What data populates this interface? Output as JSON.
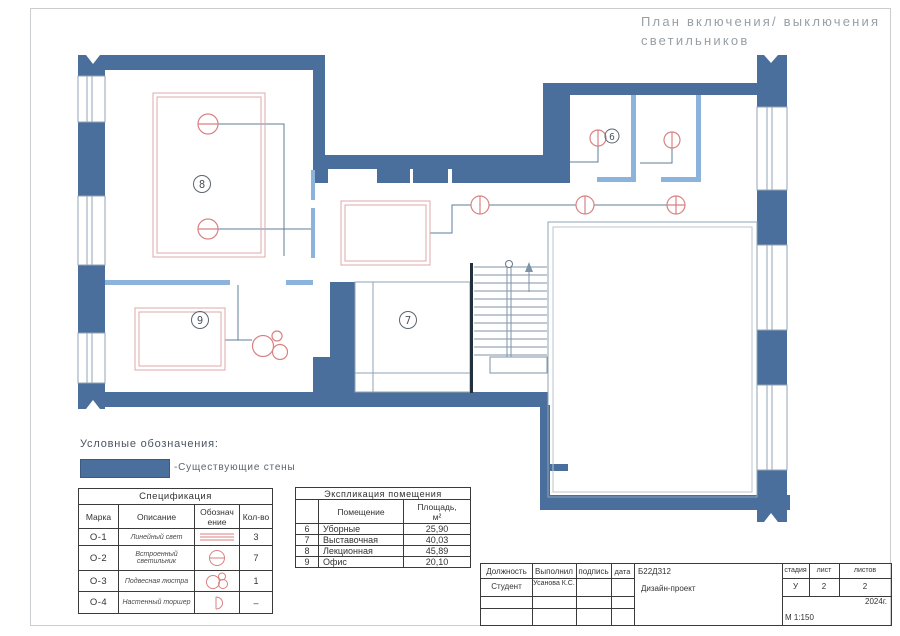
{
  "title": {
    "line1": "План включения/ выключения",
    "line2": "светильников"
  },
  "legend": {
    "heading": "Условные обозначения:",
    "wall_label": "-Существующие стены"
  },
  "rooms": {
    "r6": "6",
    "r7": "7",
    "r8": "8",
    "r9": "9"
  },
  "spec": {
    "title": "Спецификация",
    "col_mark": "Марка",
    "col_desc": "Описание",
    "col_symbol": "Обознач\nение",
    "col_qty": "Кол-во",
    "rows": [
      {
        "mark": "О-1",
        "desc": "Линейный свет",
        "symbol": "linear-light",
        "qty": "3"
      },
      {
        "mark": "О-2",
        "desc": "Встроенный светильник",
        "symbol": "recessed-light",
        "qty": "7"
      },
      {
        "mark": "О-3",
        "desc": "Подвесная люстра",
        "symbol": "pendant-chandelier",
        "qty": "1"
      },
      {
        "mark": "О-4",
        "desc": "Настенный торшер",
        "symbol": "wall-sconce",
        "qty": "–"
      }
    ]
  },
  "explication": {
    "title": "Экспликация помещения",
    "col_room": "Помещение",
    "col_area": "Площадь,\nм²",
    "rows": [
      [
        "6",
        "Уборные",
        "25,90"
      ],
      [
        "7",
        "Выставочная",
        "40,03"
      ],
      [
        "8",
        "Лекционная",
        "45,89"
      ],
      [
        "9",
        "Офис",
        "20,10"
      ]
    ]
  },
  "title_block": {
    "col_position": "Должность",
    "col_performed": "Выполнил",
    "col_signature": "подпись",
    "col_date": "дата",
    "group_code": "Б22Д312",
    "project": "Дизайн-проект",
    "col_stage": "стадия",
    "col_sheet": "лист",
    "col_sheets": "листов",
    "role": "Студент",
    "name": "Усанова К.С.",
    "stage": "У",
    "sheet": "2",
    "sheets": "2",
    "year": "2024г.",
    "scale": "М 1:150"
  },
  "colors": {
    "wall": "#4a6f9c",
    "partition": "#8cb3dc",
    "light_symbol": "#d98181",
    "wiring": "#5f7e99"
  }
}
